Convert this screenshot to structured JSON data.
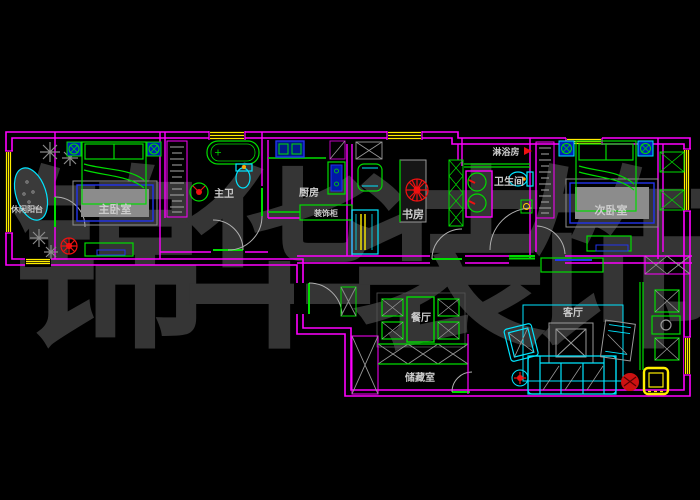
{
  "watermark": {
    "text": "锦华装饰",
    "color": "#353535"
  },
  "palette": {
    "background": "#000000",
    "wall": "#ff00ff",
    "furniture_green": "#00dd00",
    "cyan": "#00e5ff",
    "blue": "#2233ee",
    "yellow": "#ffee00",
    "red": "#ee1111",
    "label": "#cccccc",
    "gray": "#999999"
  },
  "room_labels": [
    {
      "id": "leisure-balcony",
      "text": "休闲阳台",
      "x": 27,
      "y": 212,
      "size": 8
    },
    {
      "id": "master-bedroom",
      "text": "主卧室",
      "x": 115,
      "y": 213,
      "size": 11
    },
    {
      "id": "master-bath",
      "text": "主卫",
      "x": 224,
      "y": 197,
      "size": 10
    },
    {
      "id": "kitchen",
      "text": "厨房",
      "x": 309,
      "y": 196,
      "size": 10
    },
    {
      "id": "deco-cabinet",
      "text": "装饰柜",
      "x": 326,
      "y": 216,
      "size": 8
    },
    {
      "id": "study",
      "text": "书房",
      "x": 413,
      "y": 218,
      "size": 11
    },
    {
      "id": "shower-room",
      "text": "淋浴房",
      "x": 506,
      "y": 155,
      "size": 9
    },
    {
      "id": "bathroom",
      "text": "卫生间",
      "x": 509,
      "y": 185,
      "size": 10
    },
    {
      "id": "second-bedroom",
      "text": "次卧室",
      "x": 611,
      "y": 214,
      "size": 11
    },
    {
      "id": "dining-room",
      "text": "餐厅",
      "x": 421,
      "y": 321,
      "size": 10
    },
    {
      "id": "living-room",
      "text": "客厅",
      "x": 573,
      "y": 316,
      "size": 10
    },
    {
      "id": "storage-room",
      "text": "储藏室",
      "x": 420,
      "y": 381,
      "size": 10
    }
  ]
}
